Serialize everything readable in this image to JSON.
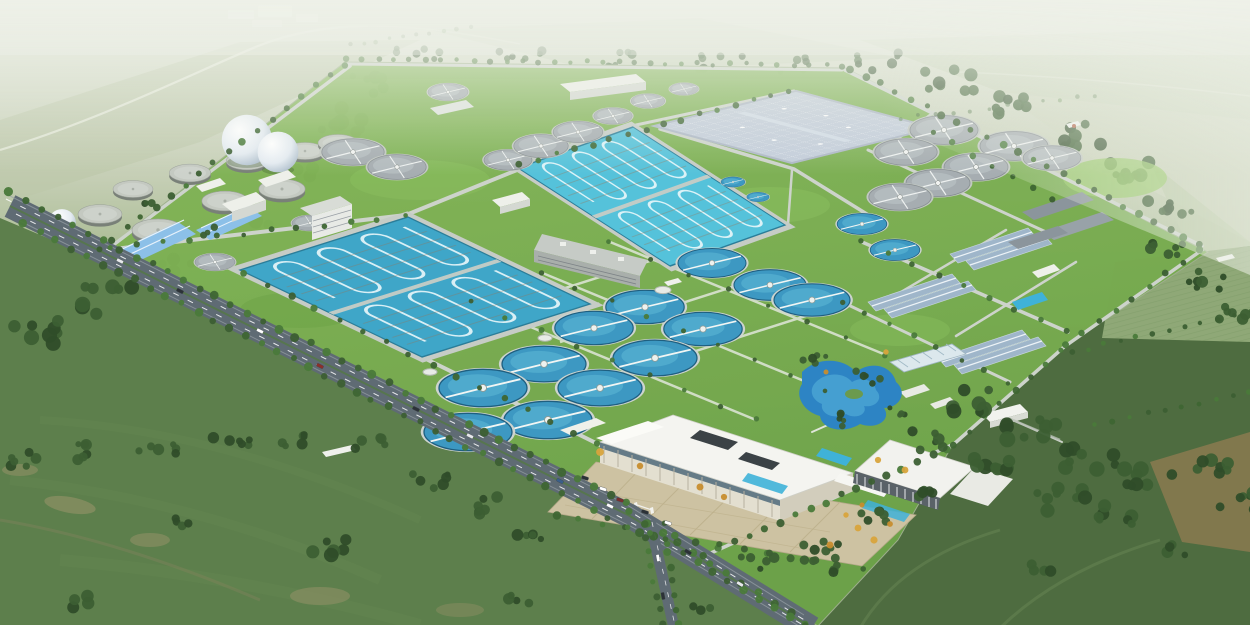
{
  "meta": {
    "title": "Photorealistic aerial bird's-eye rendering of a large wastewater treatment plant campus set in hazy green farmland",
    "view": "oblique aerial, horizon at top, strong atmospheric haze",
    "contains_text": false
  },
  "palette": {
    "sky_haze": "#e6eadf",
    "distant_field": "#c8d1ba",
    "distant_field2": "#bcc8a8",
    "field_left": "#5d7f4c",
    "field_right": "#4e6c40",
    "field_furrow": "#8fa877",
    "tilled_brown": "#8b7a50",
    "track_tan": "#a59870",
    "lawn": "#7cb050",
    "lawn_deep": "#69a044",
    "lawn_bright": "#93c763",
    "woods": "#3c5f33",
    "woods_dark": "#2f4d29",
    "tree": "#3e6633",
    "tree_yellow": "#d8a43c",
    "road_main": "#5f6b74",
    "road_internal": "#cdd3cb",
    "path_light": "#e0e6da",
    "water_basin": "#55c2da",
    "water_basin_deep": "#3fa6c8",
    "lane_line": "#eaf7f9",
    "water_circle": "#3d98c2",
    "water_circle_rim": "#1f5f80",
    "water_circle_light": "#57b2d2",
    "pond": "#2d84c4",
    "pond_light": "#4aa3d4",
    "pool_cyan": "#3fb2d8",
    "deck_gray": "#a6adb1",
    "ring_concrete": "#cdd4cf",
    "digester_top": "#c4c9c1",
    "digester_side": "#798078",
    "sphere_white": "#f2f5f8",
    "covered_roof": "#c3cdda",
    "bldg_white": "#eef0ea",
    "bldg_face": "#d4d8d2",
    "roof_blue": "#8cc0e8",
    "roof_striped": "#9fb6ca",
    "roof_slab": "#8b959c",
    "admin_roof": "#f4f4f0",
    "admin_face": "#e3dfd0",
    "plaza": "#cdc2a2",
    "plaza_line": "#bdb08c",
    "glass_dark": "#30383c",
    "car_dark": "#2c3237"
  },
  "scene": {
    "setting": "flat agricultural plain; pale hazy horizon with tiny white farm buildings upper-left; hedgerows, tilled brown patches and dark tree clumps in the surrounding fields",
    "site": {
      "shape": "large tilted rectangular fenced campus bounded by tree-lined roads, vivid lawn inside",
      "landmarks": [
        {
          "name": "digester-tank-farm",
          "desc": "cluster of flat-topped gray sludge tanks, upper-left of site",
          "count": 9
        },
        {
          "name": "gas-holder-spheres",
          "desc": "white spherical tanks beside digesters",
          "count": 3
        },
        {
          "name": "aeration-basin-upper",
          "desc": "bright cyan rectangular basin with serpentine lane lines, two modules"
        },
        {
          "name": "aeration-basin-lower",
          "desc": "large deep-teal rectangular basin with serpentine lane lines, two modules"
        },
        {
          "name": "covered-basin",
          "desc": "flat pale blue-gray covered tank block with grid seams, upper-right"
        },
        {
          "name": "gray-clarifier-cluster",
          "desc": "covered circular clarifiers with radial bridges",
          "count": 18
        },
        {
          "name": "blue-clarifier-field",
          "desc": "open circular clarifiers, blue water with white scraper bridges, centre of site",
          "count": 16
        },
        {
          "name": "process-building-cluster",
          "desc": "paired blue-gray gabled filter buildings and gray slab roofs, right side"
        },
        {
          "name": "blue-roof-warehouses",
          "desc": "light blue gabled warehouses, left side",
          "count": 2
        },
        {
          "name": "admin-building",
          "desc": "white flat-roof administration complex with courtyard openings"
        },
        {
          "name": "office-building-2",
          "desc": "second white-roof building with vertical louver facade"
        },
        {
          "name": "entrance-plaza",
          "desc": "tan paved plaza with parked cars and ornamental trees"
        },
        {
          "name": "landscape-pond",
          "desc": "winding blue garden pond with island, right of admin"
        },
        {
          "name": "greenhouse",
          "desc": "small striped-roof greenhouse near pond"
        }
      ],
      "roads": [
        {
          "name": "main-road",
          "desc": "wide dark dual carriageway with white dashes, cars and double tree rows along the lower-left boundary"
        },
        {
          "name": "access-road",
          "desc": "short road from main gate to bottom edge"
        },
        {
          "name": "internal-road-grid",
          "desc": "light concrete service roads between process units"
        }
      ]
    },
    "counts": {
      "aeration_basins": 2,
      "covered_basins": 1,
      "blue_clarifiers": 16,
      "gray_clarifiers": 18,
      "digesters": 9,
      "spheres": 3,
      "cars_visible": 17
    }
  }
}
